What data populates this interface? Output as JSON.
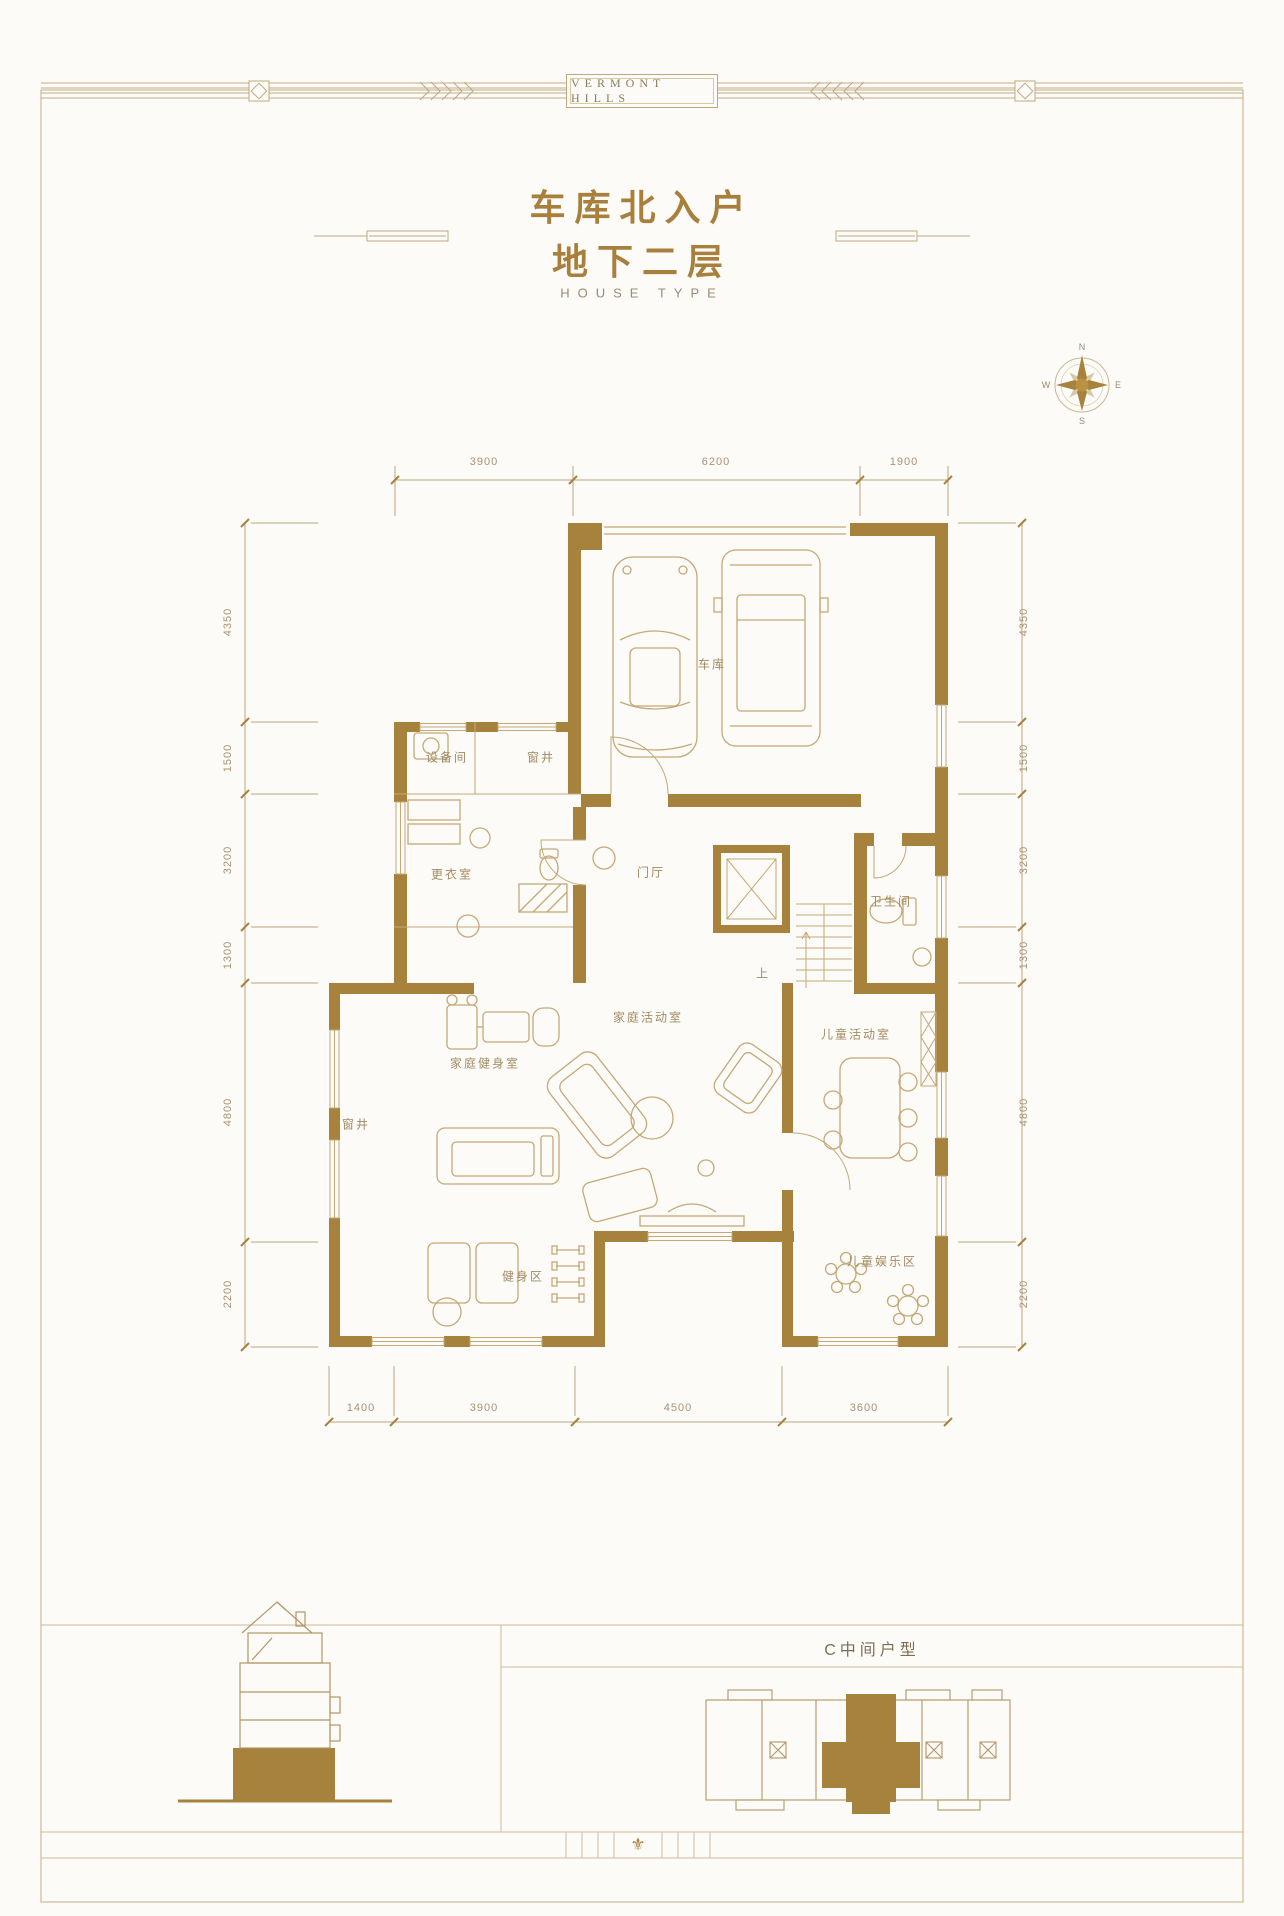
{
  "brand": {
    "name": "VERMONT HILLS"
  },
  "title": {
    "line1": "车库北入户",
    "line2": "地下二层",
    "subtitle": "HOUSE TYPE"
  },
  "compass": {
    "n": "N",
    "e": "E",
    "s": "S",
    "w": "W"
  },
  "floor_plan": {
    "rooms": [
      {
        "id": "garage",
        "label": "车库",
        "x": 712,
        "y": 664
      },
      {
        "id": "equipment-room",
        "label": "设备间",
        "x": 447,
        "y": 757
      },
      {
        "id": "window-well-top",
        "label": "窗井",
        "x": 541,
        "y": 757
      },
      {
        "id": "dressing-room",
        "label": "更衣室",
        "x": 452,
        "y": 874
      },
      {
        "id": "foyer",
        "label": "门厅",
        "x": 651,
        "y": 872
      },
      {
        "id": "bathroom",
        "label": "卫生间",
        "x": 891,
        "y": 901
      },
      {
        "id": "family-activity-room",
        "label": "家庭活动室",
        "x": 648,
        "y": 1017
      },
      {
        "id": "family-gym",
        "label": "家庭健身室",
        "x": 485,
        "y": 1063
      },
      {
        "id": "children-activity-room",
        "label": "儿童活动室",
        "x": 856,
        "y": 1034
      },
      {
        "id": "window-well-left",
        "label": "窗井",
        "x": 356,
        "y": 1124
      },
      {
        "id": "fitness-zone",
        "label": "健身区",
        "x": 523,
        "y": 1276
      },
      {
        "id": "children-play-zone",
        "label": "儿童娱乐区",
        "x": 882,
        "y": 1261
      },
      {
        "id": "stairs-up",
        "label": "上",
        "x": 763,
        "y": 973
      }
    ],
    "dimensions": {
      "top": {
        "y": 462,
        "items": [
          {
            "value": "3900",
            "x": 484
          },
          {
            "value": "6200",
            "x": 716
          },
          {
            "value": "1900",
            "x": 904
          }
        ]
      },
      "bottom": {
        "y": 1408,
        "items": [
          {
            "value": "1400",
            "x": 361
          },
          {
            "value": "3900",
            "x": 484
          },
          {
            "value": "4500",
            "x": 678
          },
          {
            "value": "3600",
            "x": 864
          }
        ]
      },
      "left": {
        "x": 228,
        "items": [
          {
            "value": "4350",
            "y": 622
          },
          {
            "value": "1500",
            "y": 758
          },
          {
            "value": "3200",
            "y": 860
          },
          {
            "value": "1300",
            "y": 955
          },
          {
            "value": "4800",
            "y": 1112
          },
          {
            "value": "2200",
            "y": 1294
          }
        ]
      },
      "right": {
        "x": 1024,
        "items": [
          {
            "value": "4350",
            "y": 622
          },
          {
            "value": "1500",
            "y": 758
          },
          {
            "value": "3200",
            "y": 860
          },
          {
            "value": "1300",
            "y": 955
          },
          {
            "value": "4800",
            "y": 1112
          },
          {
            "value": "2200",
            "y": 1294
          }
        ]
      }
    }
  },
  "footer": {
    "key_plan_title": "C中间户型",
    "ornament": "⚜"
  },
  "colors": {
    "wall_gold": "#a7823d",
    "furniture_line": "#c5a876",
    "dimension_text": "#a89272",
    "title_gold": "#a97f3c",
    "background": "#fcfbf8"
  }
}
